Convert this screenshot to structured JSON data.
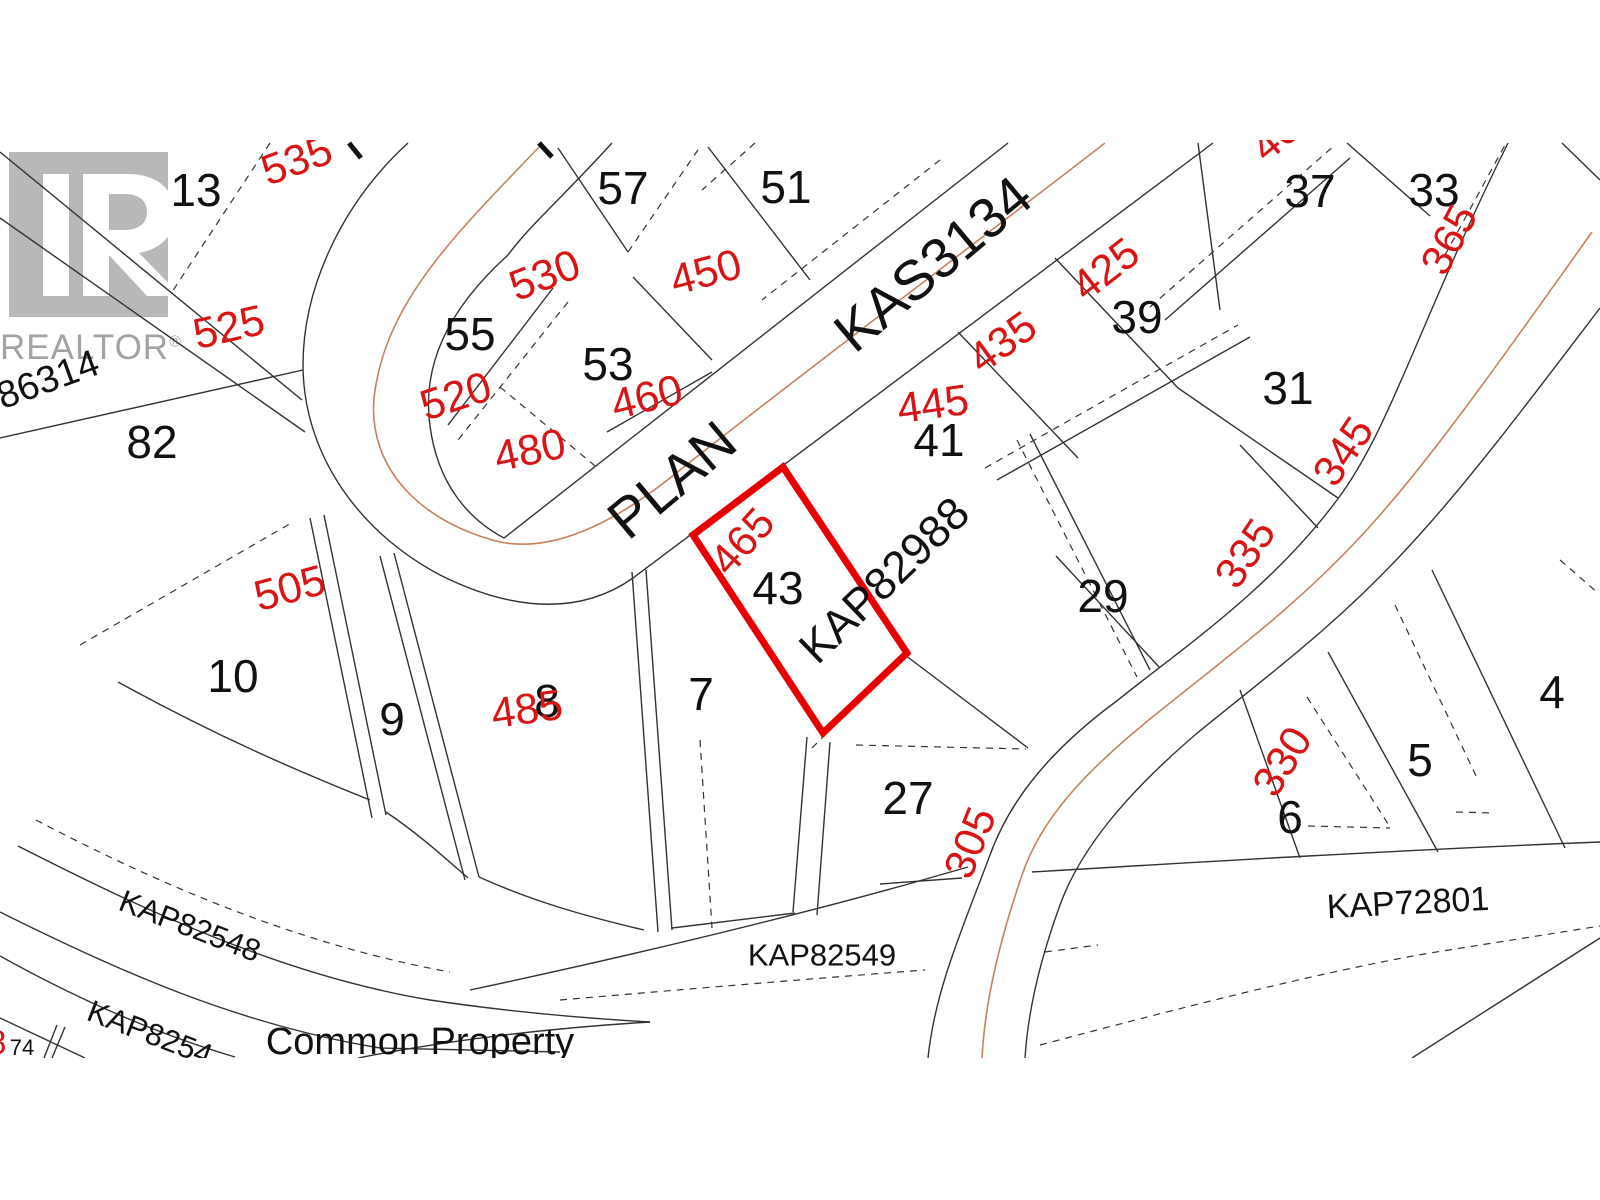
{
  "map": {
    "type": "cadastral-plat-map",
    "highlight": {
      "lot": "43",
      "outline_color": "#e80000"
    },
    "colors": {
      "background": "#ffffff",
      "parcel_line": "#333333",
      "road_centerline": "#c9805c",
      "lot_number_black": "#111111",
      "address_red": "#d81414",
      "watermark_gray": "#a9a9a9"
    },
    "watermark": {
      "logo_letter": "R",
      "wordmark": "REALTOR",
      "registered_mark": "®"
    },
    "labels": {
      "lot_numbers": [
        {
          "name": "lot-13",
          "text": "13",
          "x": 196,
          "y": 190,
          "rot": 0,
          "size": 46
        },
        {
          "name": "lot-57",
          "text": "57",
          "x": 623,
          "y": 188,
          "rot": 0,
          "size": 46
        },
        {
          "name": "lot-51",
          "text": "51",
          "x": 786,
          "y": 187,
          "rot": 0,
          "size": 46
        },
        {
          "name": "lot-37",
          "text": "37",
          "x": 1310,
          "y": 191,
          "rot": 0,
          "size": 46
        },
        {
          "name": "lot-33",
          "text": "33",
          "x": 1434,
          "y": 190,
          "rot": 0,
          "size": 46
        },
        {
          "name": "lot-55",
          "text": "55",
          "x": 470,
          "y": 334,
          "rot": 0,
          "size": 46
        },
        {
          "name": "lot-53",
          "text": "53",
          "x": 608,
          "y": 364,
          "rot": 0,
          "size": 46
        },
        {
          "name": "lot-39",
          "text": "39",
          "x": 1137,
          "y": 317,
          "rot": 0,
          "size": 46
        },
        {
          "name": "lot-31",
          "text": "31",
          "x": 1288,
          "y": 388,
          "rot": 0,
          "size": 46
        },
        {
          "name": "lot-82",
          "text": "82",
          "x": 152,
          "y": 442,
          "rot": 0,
          "size": 46
        },
        {
          "name": "lot-41",
          "text": "41",
          "x": 939,
          "y": 440,
          "rot": 0,
          "size": 46
        },
        {
          "name": "lot-43",
          "text": "43",
          "x": 778,
          "y": 588,
          "rot": 0,
          "size": 46
        },
        {
          "name": "lot-29",
          "text": "29",
          "x": 1103,
          "y": 596,
          "rot": 0,
          "size": 46
        },
        {
          "name": "lot-10",
          "text": "10",
          "x": 233,
          "y": 676,
          "rot": 0,
          "size": 46
        },
        {
          "name": "lot-9",
          "text": "9",
          "x": 392,
          "y": 719,
          "rot": 0,
          "size": 46
        },
        {
          "name": "lot-8",
          "text": "8",
          "x": 547,
          "y": 701,
          "rot": 0,
          "size": 46
        },
        {
          "name": "lot-7",
          "text": "7",
          "x": 701,
          "y": 694,
          "rot": 0,
          "size": 46
        },
        {
          "name": "lot-27",
          "text": "27",
          "x": 908,
          "y": 798,
          "rot": 0,
          "size": 46
        },
        {
          "name": "lot-6",
          "text": "6",
          "x": 1290,
          "y": 817,
          "rot": 0,
          "size": 46
        },
        {
          "name": "lot-5",
          "text": "5",
          "x": 1420,
          "y": 760,
          "rot": 0,
          "size": 46
        },
        {
          "name": "lot-4",
          "text": "4",
          "x": 1552,
          "y": 692,
          "rot": 0,
          "size": 46
        },
        {
          "name": "lot-74",
          "text": "74",
          "x": 22,
          "y": 1048,
          "rot": 0,
          "size": 22
        }
      ],
      "addresses": [
        {
          "name": "address-535",
          "text": "535",
          "x": 297,
          "y": 161,
          "rot": -20,
          "size": 43
        },
        {
          "name": "address-525",
          "text": "525",
          "x": 229,
          "y": 328,
          "rot": -13,
          "size": 43
        },
        {
          "name": "address-530",
          "text": "530",
          "x": 545,
          "y": 276,
          "rot": -21,
          "size": 43
        },
        {
          "name": "address-450",
          "text": "450",
          "x": 706,
          "y": 273,
          "rot": -15,
          "size": 43
        },
        {
          "name": "address-460",
          "text": "460",
          "x": 647,
          "y": 398,
          "rot": -14,
          "size": 43
        },
        {
          "name": "address-520",
          "text": "520",
          "x": 456,
          "y": 397,
          "rot": -18,
          "size": 43
        },
        {
          "name": "address-480",
          "text": "480",
          "x": 530,
          "y": 451,
          "rot": -12,
          "size": 43
        },
        {
          "name": "address-505",
          "text": "505",
          "x": 290,
          "y": 589,
          "rot": -15,
          "size": 43
        },
        {
          "name": "address-485",
          "text": "485",
          "x": 527,
          "y": 710,
          "rot": -8,
          "size": 43
        },
        {
          "name": "address-465",
          "text": "465",
          "x": 743,
          "y": 542,
          "rot": -48,
          "size": 43
        },
        {
          "name": "address-445",
          "text": "445",
          "x": 933,
          "y": 405,
          "rot": -8,
          "size": 43
        },
        {
          "name": "address-435",
          "text": "435",
          "x": 1003,
          "y": 343,
          "rot": -36,
          "size": 43
        },
        {
          "name": "address-425",
          "text": "425",
          "x": 1106,
          "y": 270,
          "rot": -38,
          "size": 43
        },
        {
          "name": "address-365",
          "text": "365",
          "x": 1450,
          "y": 240,
          "rot": -62,
          "size": 43
        },
        {
          "name": "address-345",
          "text": "345",
          "x": 1344,
          "y": 452,
          "rot": -56,
          "size": 43
        },
        {
          "name": "address-335",
          "text": "335",
          "x": 1246,
          "y": 554,
          "rot": -56,
          "size": 43
        },
        {
          "name": "address-330",
          "text": "330",
          "x": 1283,
          "y": 762,
          "rot": -58,
          "size": 43
        },
        {
          "name": "address-305",
          "text": "305",
          "x": 971,
          "y": 843,
          "rot": -68,
          "size": 43
        },
        {
          "name": "address-partial-top",
          "text": "40",
          "x": 1276,
          "y": 138,
          "rot": -40,
          "size": 43
        },
        {
          "name": "address-partial-left",
          "text": "8",
          "x": -3,
          "y": 1043,
          "rot": 0,
          "size": 34
        }
      ],
      "plan_labels": [
        {
          "name": "plan-word-plan",
          "text": "PLAN",
          "x": 672,
          "y": 480,
          "rot": -40,
          "size": 56
        },
        {
          "name": "plan-word-kas3134",
          "text": "KAS3134",
          "x": 933,
          "y": 264,
          "rot": -40,
          "size": 56
        },
        {
          "name": "plan-kap82988",
          "text": "KAP82988",
          "x": 884,
          "y": 580,
          "rot": -44,
          "size": 45
        },
        {
          "name": "plan-kap82548",
          "text": "KAP82548",
          "x": 190,
          "y": 926,
          "rot": 21,
          "size": 31
        },
        {
          "name": "plan-kap8254-partial",
          "text": "KAP8254",
          "x": 150,
          "y": 1033,
          "rot": 21,
          "size": 31
        },
        {
          "name": "plan-kap82549",
          "text": "KAP82549",
          "x": 822,
          "y": 955,
          "rot": 0,
          "size": 31
        },
        {
          "name": "plan-kap72801",
          "text": "KAP72801",
          "x": 1408,
          "y": 903,
          "rot": -3,
          "size": 34
        },
        {
          "name": "common-property-label",
          "text": "Common Property",
          "x": 420,
          "y": 1042,
          "rot": 0,
          "size": 38
        },
        {
          "name": "plan-86314-partial",
          "text": "86314",
          "x": 48,
          "y": 380,
          "rot": -20,
          "size": 38
        }
      ]
    }
  }
}
